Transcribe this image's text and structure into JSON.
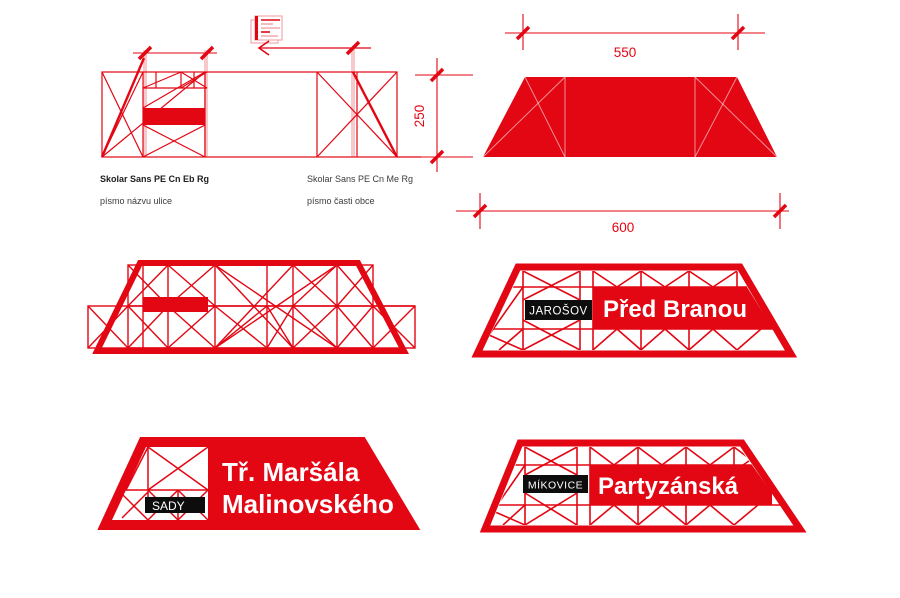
{
  "colors": {
    "signal_red": "#e30613",
    "light_pink": "#f3a9ad",
    "badge_black": "#0d0d0d",
    "note_text": "#3b3b3b"
  },
  "dimensions": {
    "top_width": "550",
    "height": "250",
    "bottom_width": "600"
  },
  "font_notes": {
    "street_name": {
      "font": "Skolar Sans PE Cn Eb Rg",
      "label": "písmo názvu ulice"
    },
    "district": {
      "font": "Skolar Sans PE Cn Me Rg",
      "label": "písmo časti obce"
    }
  },
  "signs": {
    "jarosov": {
      "district": "JAROŠOV",
      "street": "Před Branou"
    },
    "sady": {
      "district": "SADY",
      "street_line1": "Tř. Maršála",
      "street_line2": "Malinovského"
    },
    "mikovice": {
      "district": "MÍKOVICE",
      "street": "Partyzánská"
    }
  },
  "icons": {
    "document": "document-lines-icon",
    "arrow": "arrow-left-icon"
  }
}
